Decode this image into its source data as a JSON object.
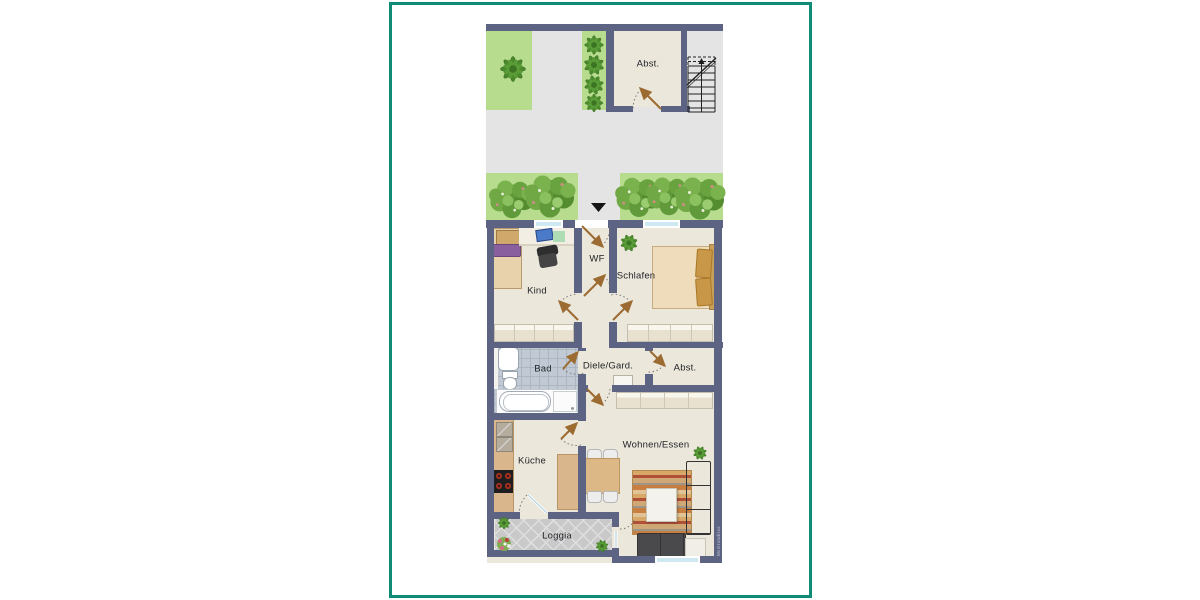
{
  "plan": {
    "watermark": "McGrundriss",
    "rooms": {
      "abst_top": "Abst.",
      "wf": "WF",
      "kind": "Kind",
      "schlafen": "Schlafen",
      "bad": "Bad",
      "diele": "Diele/Gard.",
      "abst": "Abst.",
      "kueche": "Küche",
      "wohnen": "Wohnen/Essen",
      "loggia": "Loggia"
    },
    "colors": {
      "frame": "#0F8B76",
      "wall": "#5C6383",
      "floor": "#ECE7DB",
      "pavement": "#E4E4E4",
      "lawn": "#B7DC8E",
      "bath_tile": "#C1CAD4",
      "loggia_tile": "#C9C9C9",
      "door_swing": "#9C6B32",
      "window_glass": "#CFE9F2"
    }
  }
}
